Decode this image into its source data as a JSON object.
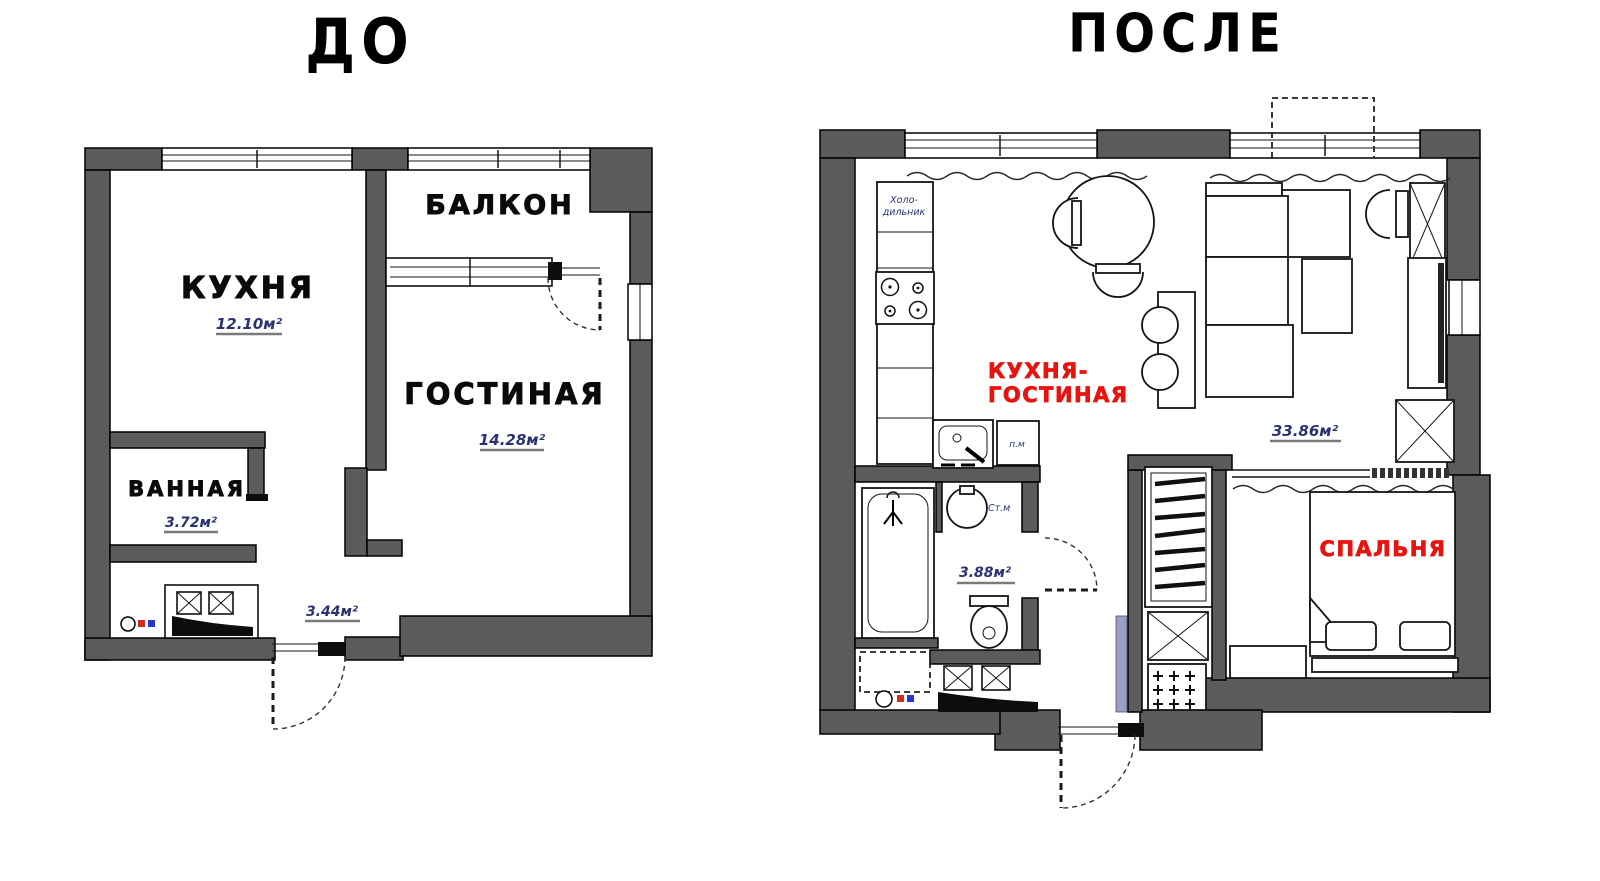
{
  "titles": {
    "before": "ДО",
    "after": "ПОСЛЕ"
  },
  "colors": {
    "background": "#ffffff",
    "wall_fill": "#5b5b5b",
    "outline": "#000000",
    "room_label": "#0a0a0a",
    "area_label": "#2a3272",
    "area_underline": "#7a7a7a",
    "highlight_label": "#e8120e",
    "hot_water_riser": "#d42a1e",
    "cold_water_riser": "#2a35cc",
    "sliding_panel": "#99a0c7"
  },
  "before_plan": {
    "rooms": {
      "kitchen": {
        "name": "КУХНЯ",
        "area": "12.10м²"
      },
      "balcony": {
        "name": "БАЛКОН"
      },
      "living_room": {
        "name": "ГОСТИНАЯ",
        "area": "14.28м²"
      },
      "bathroom": {
        "name": "ВАННАЯ",
        "area": "3.72м²"
      },
      "hallway": {
        "area": "3.44м²"
      }
    }
  },
  "after_plan": {
    "rooms": {
      "kitchen_living": {
        "name_line1": "КУХНЯ-",
        "name_line2": "ГОСТИНАЯ",
        "area": "33.86м²"
      },
      "bedroom": {
        "name": "СПАЛЬНЯ"
      },
      "bathroom": {
        "area": "3.88м²"
      }
    },
    "labels": {
      "fridge_line1": "Холо-",
      "fridge_line2": "дильник",
      "dishwasher": "п.м",
      "washing_machine": "Ст.м"
    }
  }
}
